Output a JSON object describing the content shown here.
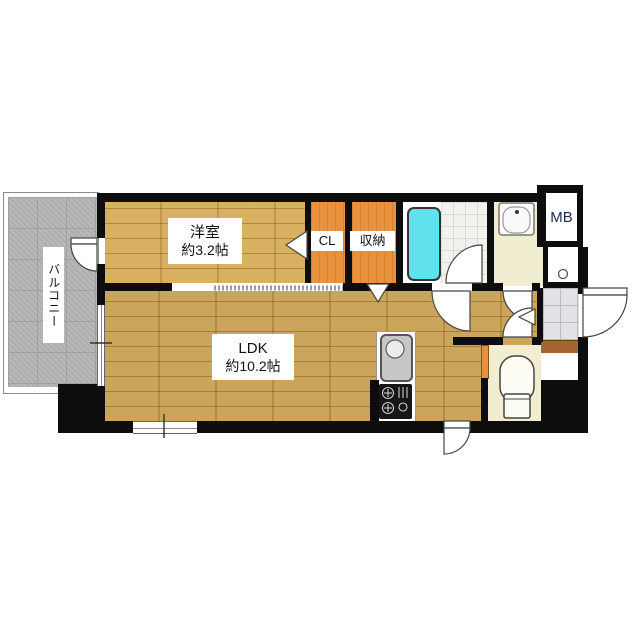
{
  "floorplan": {
    "title": "1K apartment floor plan",
    "rooms": {
      "balcony": {
        "label": "バルコニー"
      },
      "western_room": {
        "label": "洋室",
        "size": "約3.2帖"
      },
      "closet": {
        "label": "CL"
      },
      "storage": {
        "label": "収納"
      },
      "ldk": {
        "label": "LDK",
        "size": "約10.2帖"
      },
      "meter_box": {
        "label": "MB"
      }
    },
    "colors": {
      "wall": "#0d0d0d",
      "wood_floor": "#c69e4f",
      "closet_floor": "#e8923d",
      "bathtub": "#5fe2ee",
      "bath_tile": "#f1f1ed",
      "cream_floor": "#f0edd0",
      "entrance_tile": "#e1e1e6",
      "balcony_concrete": "#b5b5b5",
      "step_wood": "#a5652f",
      "background": "#ffffff"
    }
  }
}
